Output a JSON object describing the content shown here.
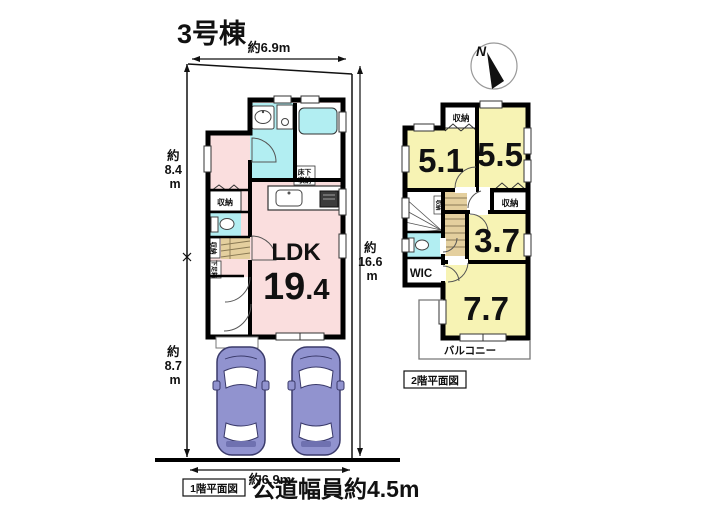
{
  "title": "3号棟",
  "compass": {
    "north_label": "N"
  },
  "dimensions": {
    "top_width": "約6.9m",
    "left_upper": {
      "l1": "約",
      "l2": "8.4",
      "l3": "m"
    },
    "left_lower": {
      "l1": "約",
      "l2": "8.7",
      "l3": "m"
    },
    "right_depth": {
      "l1": "約",
      "l2": "16.6",
      "l3": "m"
    },
    "bottom_width": "約6.9m",
    "road_width": "公道幅員約4.5m"
  },
  "floor1": {
    "caption": "1階平面図",
    "ldk": {
      "name": "LDK",
      "area_main": "19",
      "area_decimal": ".4"
    },
    "labels": {
      "storage_hall": "収納",
      "storage_under_stairs": "収納",
      "shoe_box": "下足箱",
      "underfloor_storage_l1": "床下",
      "underfloor_storage_l2": "収納"
    }
  },
  "floor2": {
    "caption": "2階平面図",
    "rooms": [
      {
        "label": "5.1"
      },
      {
        "label": "5.5"
      },
      {
        "label": "3.7"
      },
      {
        "label": "7.7"
      }
    ],
    "labels": {
      "storage_top": "収納",
      "storage_right": "収納",
      "storage_stairs": "収納",
      "wic": "WIC",
      "balcony": "バルコニー"
    }
  },
  "colors": {
    "room_pink": "#fadede",
    "room_yellow": "#f7f3b4",
    "wet_cyan": "#b2eef2",
    "stairs_tan": "#e4cf9e",
    "car_body": "#9193cf",
    "wall": "#000000"
  }
}
